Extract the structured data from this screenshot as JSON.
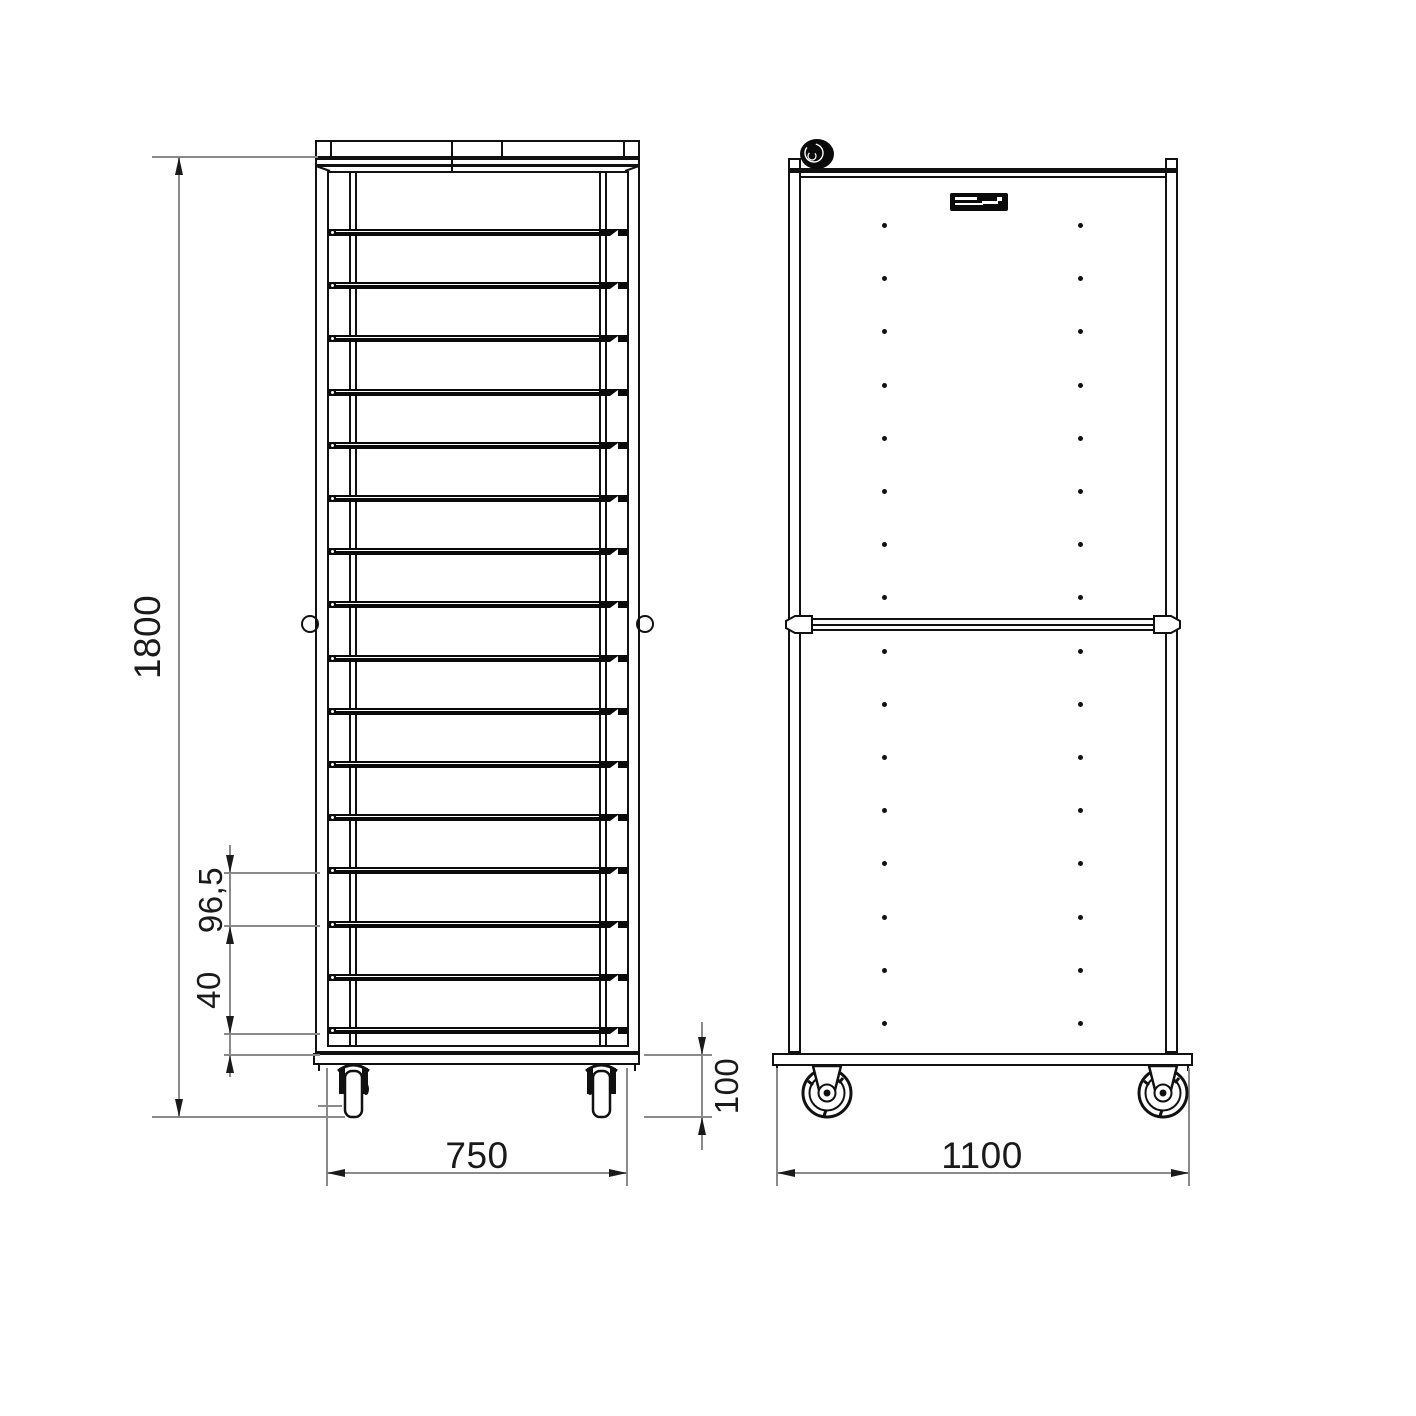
{
  "drawing_type": "technical-drawing",
  "views": {
    "front_view": {
      "name": "front elevation of tray rack trolley",
      "shelf_count": 16,
      "shelf_first_y": 229,
      "shelf_spacing": 53.2
    },
    "side_view": {
      "name": "side elevation of tray rack trolley",
      "hole_rows": 16,
      "hole_columns": 2,
      "hole_first_y": 223,
      "hole_spacing": 53.2,
      "hole_col_x": [
        884,
        1080
      ],
      "brand_plate_icon": "logo-plate",
      "knob_icon": "hand-knob"
    }
  },
  "dimensions": {
    "height": "1800",
    "shelf_pitch": "96,5",
    "bottom_gap": "40",
    "front_width": "750",
    "caster_height": "100",
    "depth": "1100"
  },
  "colors": {
    "paper": "#ffffff",
    "ink": "#111111",
    "dim_line": "#8a8a8a",
    "text": "#1a1a1a"
  }
}
